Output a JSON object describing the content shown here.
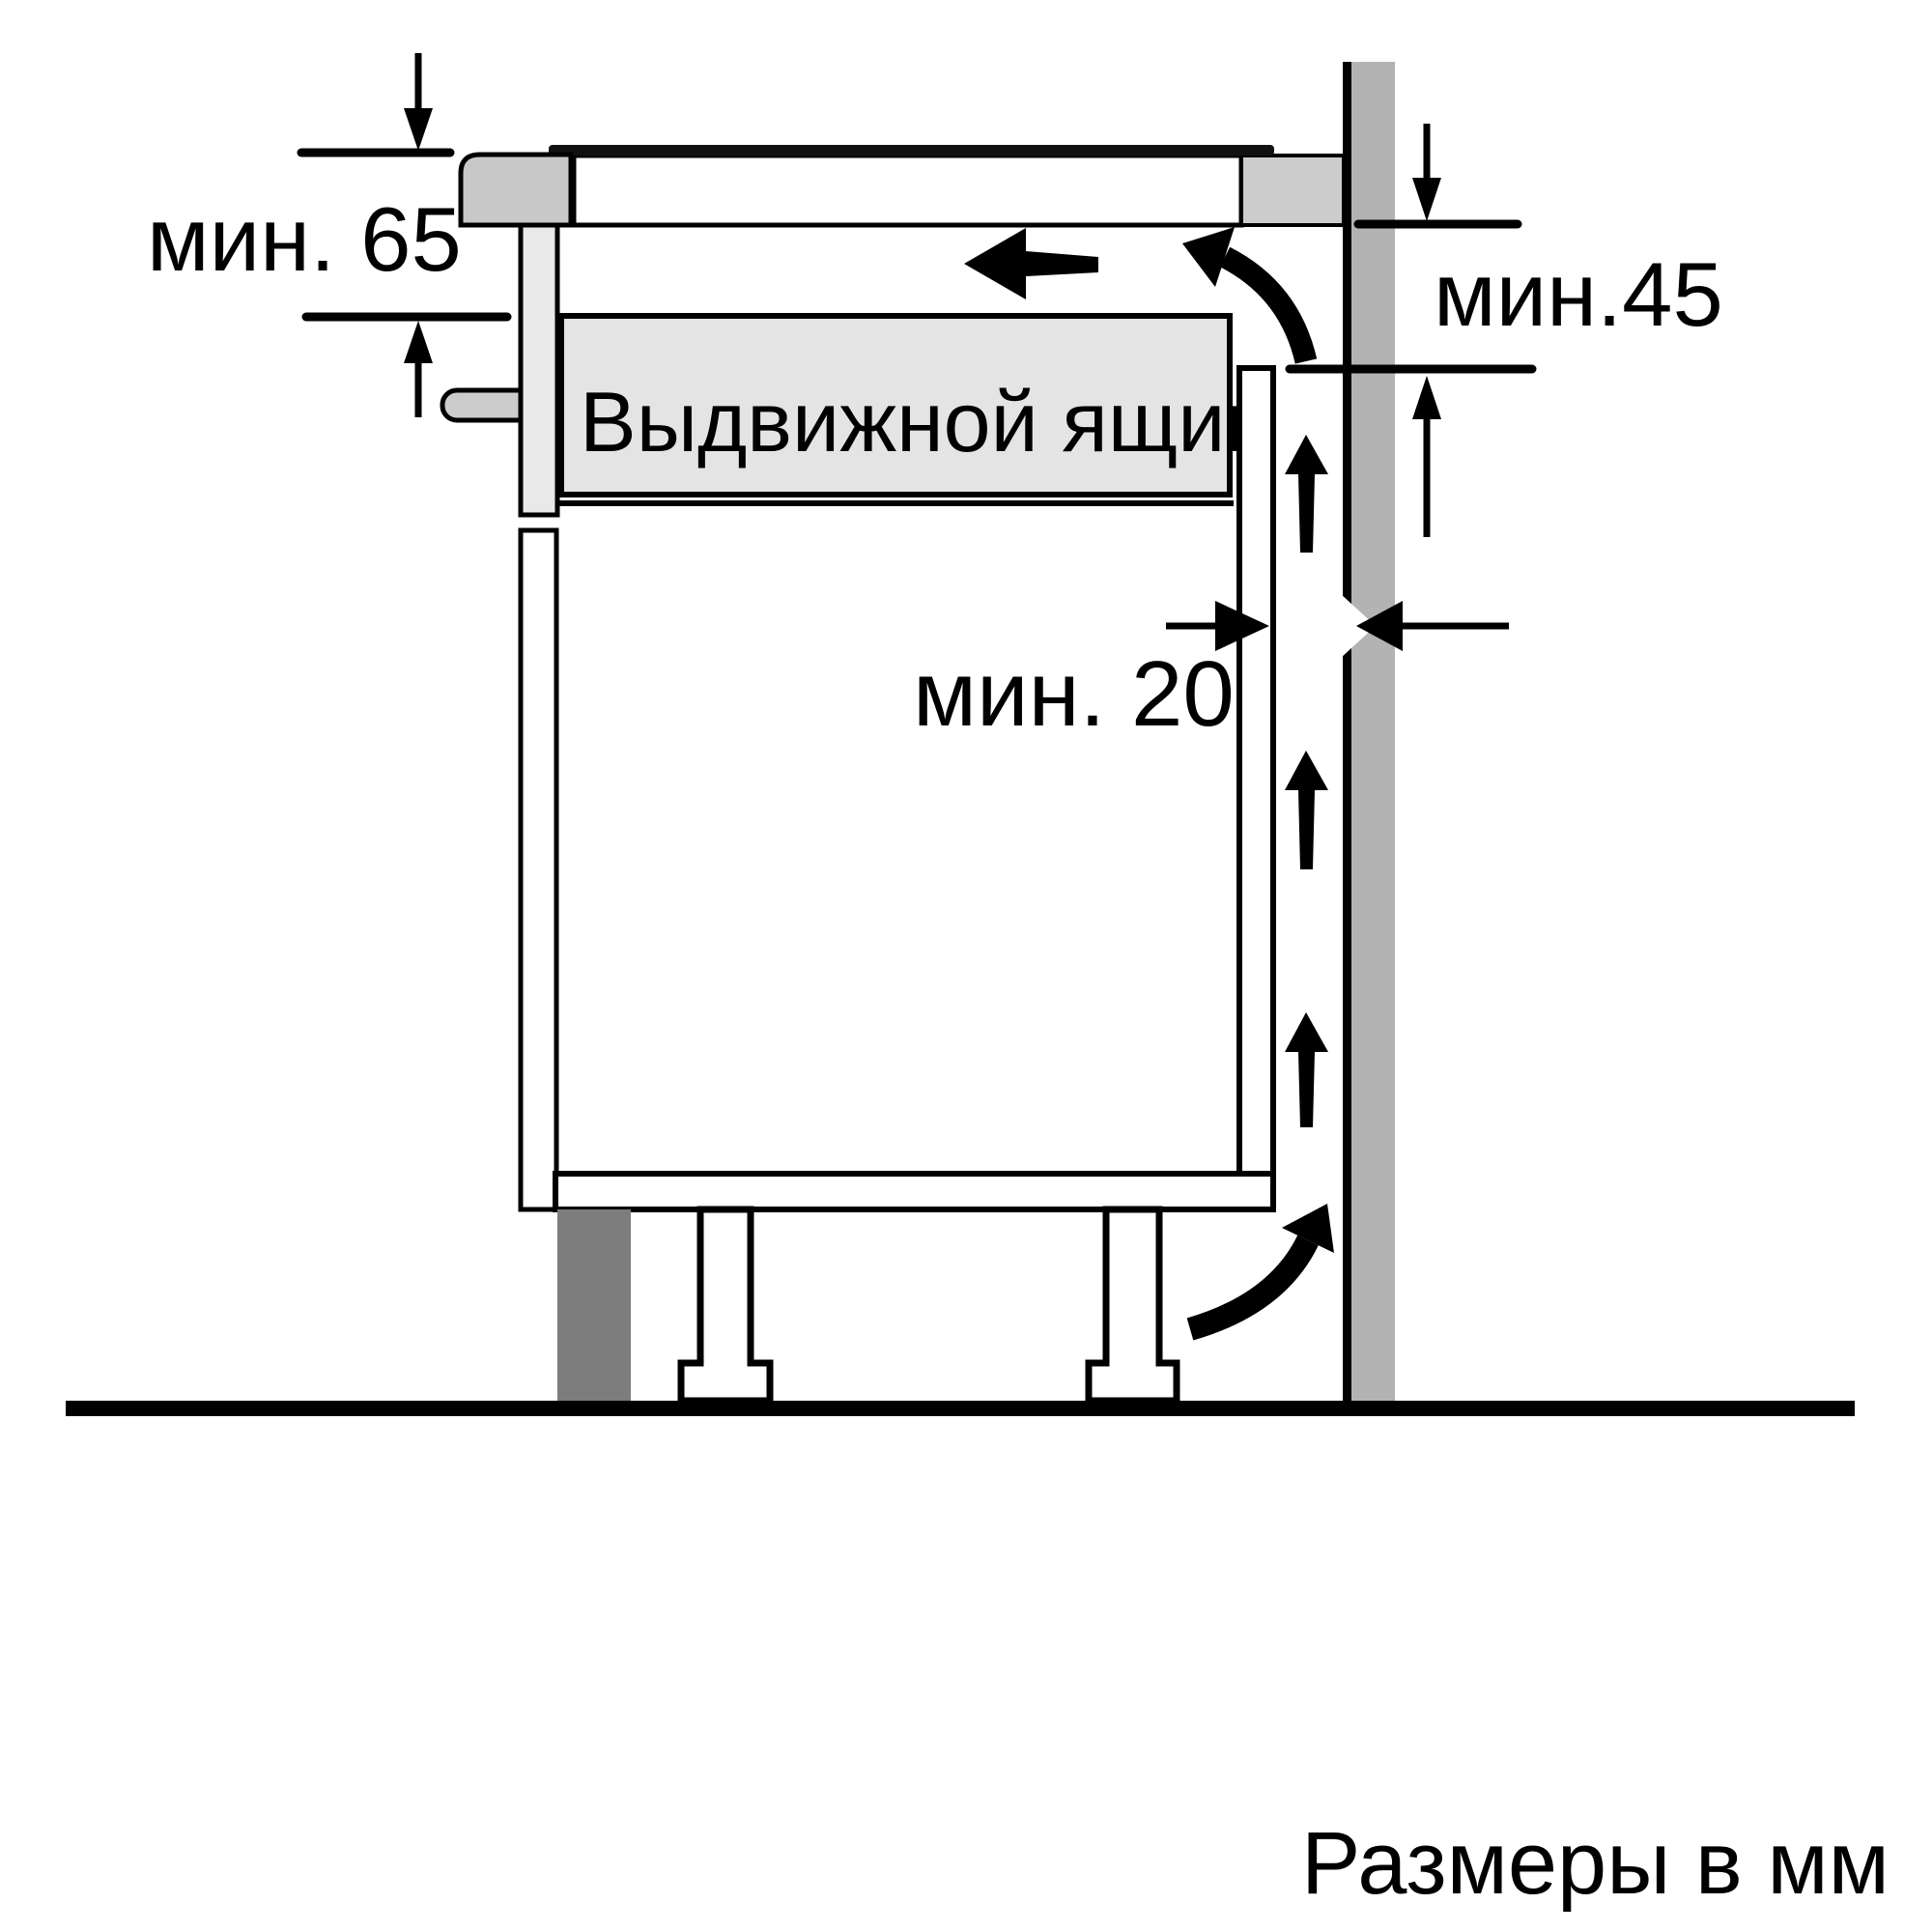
{
  "diagram": {
    "units_note": "Размеры в мм",
    "drawer_label": "Выдвижной ящик",
    "dimensions": {
      "top_left": "мин. 65",
      "top_right": "мин.45",
      "side_gap": "мин. 20"
    }
  },
  "colors": {
    "wall": "#b3b3b3",
    "worktop_end_block": "#cccccc",
    "cooktop_panel": "#c8c8c8",
    "cooktop_housing": "#e9e9e9",
    "drawer_fill": "#e4e4e4",
    "plinth_dark": "#7d7d7d",
    "line": "#000000"
  }
}
